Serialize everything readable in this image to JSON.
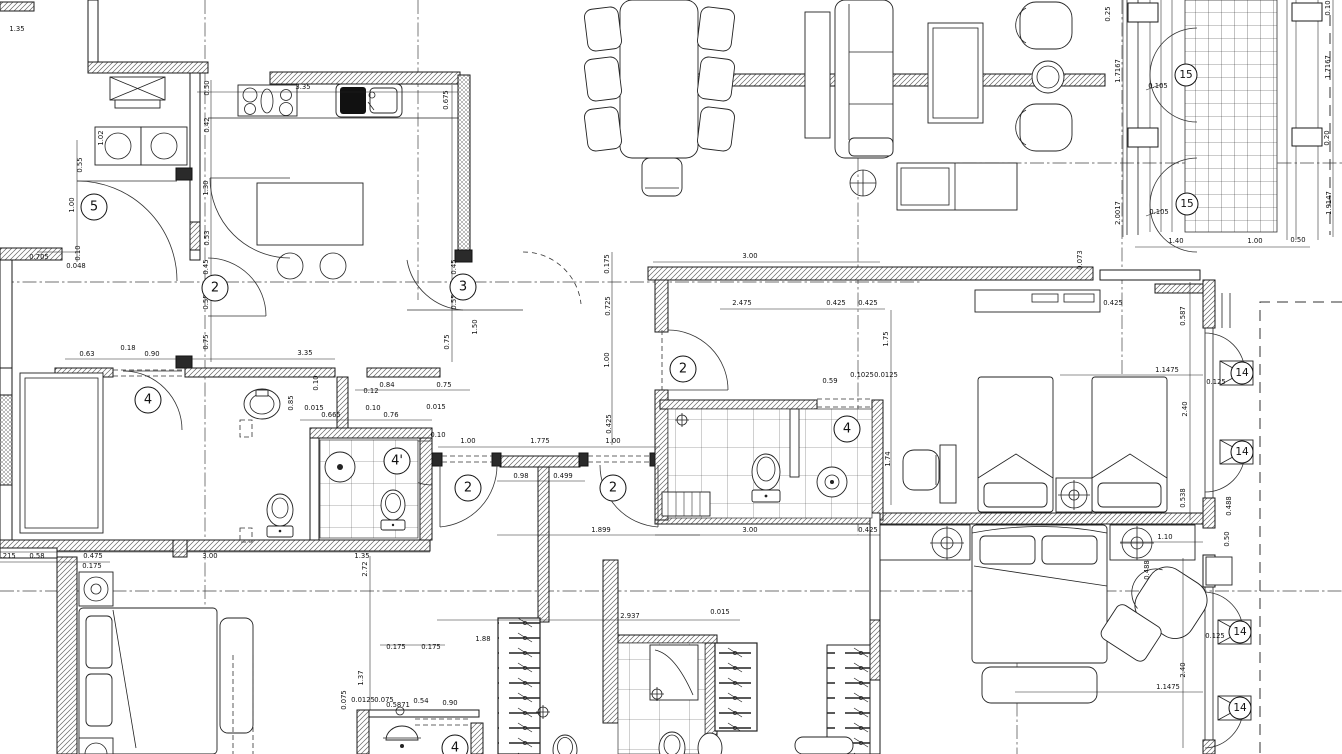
{
  "drawing": {
    "title": "apartment-floor-plan",
    "type": "architectural-cad-plan",
    "colors": {
      "paper": "#ffffff",
      "ink": "#1a1a1a"
    },
    "room_labels": [
      {
        "text": "5",
        "x": 94,
        "y": 207
      },
      {
        "text": "2",
        "x": 215,
        "y": 288
      },
      {
        "text": "3",
        "x": 463,
        "y": 287
      },
      {
        "text": "4",
        "x": 148,
        "y": 400
      },
      {
        "text": "4'",
        "x": 397,
        "y": 461
      },
      {
        "text": "2",
        "x": 468,
        "y": 488
      },
      {
        "text": "2",
        "x": 613,
        "y": 488
      },
      {
        "text": "2",
        "x": 683,
        "y": 369
      },
      {
        "text": "4",
        "x": 847,
        "y": 429
      },
      {
        "text": "15",
        "x": 1186,
        "y": 75
      },
      {
        "text": "15",
        "x": 1187,
        "y": 204
      },
      {
        "text": "14",
        "x": 1242,
        "y": 373
      },
      {
        "text": "14",
        "x": 1242,
        "y": 452
      },
      {
        "text": "14",
        "x": 1240,
        "y": 632
      },
      {
        "text": "14",
        "x": 1240,
        "y": 708
      },
      {
        "text": "4",
        "x": 455,
        "y": 748
      }
    ],
    "dimensions": [
      {
        "text": "1.35",
        "x": 17,
        "y": 31,
        "rot": 0
      },
      {
        "text": "0.705",
        "x": 39,
        "y": 259,
        "rot": 0
      },
      {
        "text": "0.048",
        "x": 76,
        "y": 268,
        "rot": 0
      },
      {
        "text": "3.35",
        "x": 303,
        "y": 89,
        "rot": 0
      },
      {
        "text": "0.63",
        "x": 87,
        "y": 356,
        "rot": 0
      },
      {
        "text": "0.18",
        "x": 128,
        "y": 350,
        "rot": 0
      },
      {
        "text": "0.90",
        "x": 152,
        "y": 356,
        "rot": 0
      },
      {
        "text": "3.35",
        "x": 305,
        "y": 355,
        "rot": 0
      },
      {
        "text": "0.84",
        "x": 387,
        "y": 387,
        "rot": 0
      },
      {
        "text": "0.75",
        "x": 444,
        "y": 387,
        "rot": 0
      },
      {
        "text": "0.12",
        "x": 371,
        "y": 393,
        "rot": 0
      },
      {
        "text": "0.10",
        "x": 373,
        "y": 410,
        "rot": 0
      },
      {
        "text": "0.015",
        "x": 314,
        "y": 410,
        "rot": 0
      },
      {
        "text": "0.665",
        "x": 331,
        "y": 417,
        "rot": 0
      },
      {
        "text": "0.76",
        "x": 391,
        "y": 417,
        "rot": 0
      },
      {
        "text": "0.215",
        "x": 6,
        "y": 558,
        "rot": 0
      },
      {
        "text": "0.58",
        "x": 37,
        "y": 558,
        "rot": 0
      },
      {
        "text": "0.475",
        "x": 93,
        "y": 558,
        "rot": 0
      },
      {
        "text": "3.00",
        "x": 210,
        "y": 558,
        "rot": 0
      },
      {
        "text": "1.35",
        "x": 362,
        "y": 558,
        "rot": 0
      },
      {
        "text": "0.175",
        "x": 92,
        "y": 568,
        "rot": 0
      },
      {
        "text": "0.015",
        "x": 436,
        "y": 409,
        "rot": 0
      },
      {
        "text": "1.00",
        "x": 468,
        "y": 443,
        "rot": 0
      },
      {
        "text": "1.775",
        "x": 540,
        "y": 443,
        "rot": 0
      },
      {
        "text": "1.00",
        "x": 613,
        "y": 443,
        "rot": 0
      },
      {
        "text": "0.98",
        "x": 521,
        "y": 478,
        "rot": 0
      },
      {
        "text": "0.499",
        "x": 563,
        "y": 478,
        "rot": 0
      },
      {
        "text": "1.899",
        "x": 601,
        "y": 532,
        "rot": 0
      },
      {
        "text": "0.10",
        "x": 438,
        "y": 437,
        "rot": 0
      },
      {
        "text": "3.00",
        "x": 750,
        "y": 258,
        "rot": 0
      },
      {
        "text": "2.475",
        "x": 742,
        "y": 305,
        "rot": 0
      },
      {
        "text": "0.425",
        "x": 836,
        "y": 305,
        "rot": 0
      },
      {
        "text": "0.425",
        "x": 868,
        "y": 305,
        "rot": 0
      },
      {
        "text": "0.59",
        "x": 830,
        "y": 383,
        "rot": 0
      },
      {
        "text": "0.1025",
        "x": 862,
        "y": 377,
        "rot": 0
      },
      {
        "text": "0.0125",
        "x": 886,
        "y": 377,
        "rot": 0
      },
      {
        "text": "3.00",
        "x": 750,
        "y": 532,
        "rot": 0
      },
      {
        "text": "0.425",
        "x": 868,
        "y": 532,
        "rot": 0
      },
      {
        "text": "1.40",
        "x": 1176,
        "y": 243,
        "rot": 0
      },
      {
        "text": "1.00",
        "x": 1255,
        "y": 243,
        "rot": 0
      },
      {
        "text": "0.50",
        "x": 1298,
        "y": 242,
        "rot": 0
      },
      {
        "text": "0.105",
        "x": 1158,
        "y": 88,
        "rot": 0
      },
      {
        "text": "0.105",
        "x": 1159,
        "y": 214,
        "rot": 0
      },
      {
        "text": "1.1475",
        "x": 1167,
        "y": 372,
        "rot": 0
      },
      {
        "text": "0.425",
        "x": 1113,
        "y": 305,
        "rot": 0
      },
      {
        "text": "0.125",
        "x": 1216,
        "y": 384,
        "rot": 0
      },
      {
        "text": "1.10",
        "x": 1165,
        "y": 539,
        "rot": 0
      },
      {
        "text": "1.1475",
        "x": 1168,
        "y": 689,
        "rot": 0
      },
      {
        "text": "0.125",
        "x": 1215,
        "y": 638,
        "rot": 0
      },
      {
        "text": "2.937",
        "x": 630,
        "y": 618,
        "rot": 0
      },
      {
        "text": "0.015",
        "x": 720,
        "y": 614,
        "rot": 0
      },
      {
        "text": "1.88",
        "x": 483,
        "y": 641,
        "rot": 0
      },
      {
        "text": "0.175",
        "x": 396,
        "y": 649,
        "rot": 0
      },
      {
        "text": "0.175",
        "x": 431,
        "y": 649,
        "rot": 0
      },
      {
        "text": "0.0125",
        "x": 363,
        "y": 702,
        "rot": 0
      },
      {
        "text": "0.075",
        "x": 384,
        "y": 702,
        "rot": 0
      },
      {
        "text": "0.5871",
        "x": 398,
        "y": 707,
        "rot": 0
      },
      {
        "text": "0.54",
        "x": 421,
        "y": 703,
        "rot": 0
      },
      {
        "text": "0.90",
        "x": 450,
        "y": 705,
        "rot": 0
      },
      {
        "text": "0.50",
        "x": 209,
        "y": 88,
        "rot": -90
      },
      {
        "text": "0.42",
        "x": 209,
        "y": 125,
        "rot": -90
      },
      {
        "text": "1.30",
        "x": 208,
        "y": 188,
        "rot": -90
      },
      {
        "text": "0.53",
        "x": 209,
        "y": 238,
        "rot": -90
      },
      {
        "text": "0.45",
        "x": 208,
        "y": 267,
        "rot": -90
      },
      {
        "text": "0.55",
        "x": 208,
        "y": 302,
        "rot": -90
      },
      {
        "text": "0.75",
        "x": 208,
        "y": 342,
        "rot": -90
      },
      {
        "text": "1.00",
        "x": 74,
        "y": 205,
        "rot": -90
      },
      {
        "text": "0.55",
        "x": 82,
        "y": 165,
        "rot": -90
      },
      {
        "text": "1.02",
        "x": 103,
        "y": 138,
        "rot": -90
      },
      {
        "text": "0.10",
        "x": 80,
        "y": 253,
        "rot": -90
      },
      {
        "text": "0.675",
        "x": 448,
        "y": 100,
        "rot": -90
      },
      {
        "text": "0.45",
        "x": 456,
        "y": 267,
        "rot": -90
      },
      {
        "text": "0.55",
        "x": 456,
        "y": 302,
        "rot": -90
      },
      {
        "text": "0.75",
        "x": 449,
        "y": 342,
        "rot": -90
      },
      {
        "text": "1.50",
        "x": 477,
        "y": 327,
        "rot": -90
      },
      {
        "text": "0.85",
        "x": 293,
        "y": 403,
        "rot": -90
      },
      {
        "text": "0.10",
        "x": 318,
        "y": 383,
        "rot": -90
      },
      {
        "text": "0.175",
        "x": 609,
        "y": 264,
        "rot": -90
      },
      {
        "text": "0.725",
        "x": 610,
        "y": 306,
        "rot": -90
      },
      {
        "text": "1.00",
        "x": 609,
        "y": 360,
        "rot": -90
      },
      {
        "text": "0.425",
        "x": 611,
        "y": 424,
        "rot": -90
      },
      {
        "text": "1.75",
        "x": 888,
        "y": 339,
        "rot": -90
      },
      {
        "text": "1.74",
        "x": 890,
        "y": 459,
        "rot": -90
      },
      {
        "text": "1.7167",
        "x": 1120,
        "y": 71,
        "rot": -90
      },
      {
        "text": "2.0017",
        "x": 1120,
        "y": 213,
        "rot": -90
      },
      {
        "text": "1.7167",
        "x": 1330,
        "y": 67,
        "rot": -90
      },
      {
        "text": "1.9147",
        "x": 1331,
        "y": 203,
        "rot": -90
      },
      {
        "text": "0.073",
        "x": 1082,
        "y": 260,
        "rot": -90
      },
      {
        "text": "0.587",
        "x": 1185,
        "y": 316,
        "rot": -90
      },
      {
        "text": "2.40",
        "x": 1187,
        "y": 409,
        "rot": -90
      },
      {
        "text": "0.538",
        "x": 1185,
        "y": 498,
        "rot": -90
      },
      {
        "text": "0.488",
        "x": 1231,
        "y": 506,
        "rot": -90
      },
      {
        "text": "0.50",
        "x": 1229,
        "y": 539,
        "rot": -90
      },
      {
        "text": "2.40",
        "x": 1185,
        "y": 670,
        "rot": -90
      },
      {
        "text": "0.488",
        "x": 1149,
        "y": 570,
        "rot": -90
      },
      {
        "text": "2.72",
        "x": 367,
        "y": 569,
        "rot": -90
      },
      {
        "text": "1.37",
        "x": 363,
        "y": 678,
        "rot": -90
      },
      {
        "text": "0.075",
        "x": 346,
        "y": 700,
        "rot": -90
      },
      {
        "text": "0.25",
        "x": 1110,
        "y": 14,
        "rot": -90
      },
      {
        "text": "0.10",
        "x": 1330,
        "y": 8,
        "rot": -90
      },
      {
        "text": "0.20",
        "x": 1329,
        "y": 138,
        "rot": -90
      }
    ]
  }
}
